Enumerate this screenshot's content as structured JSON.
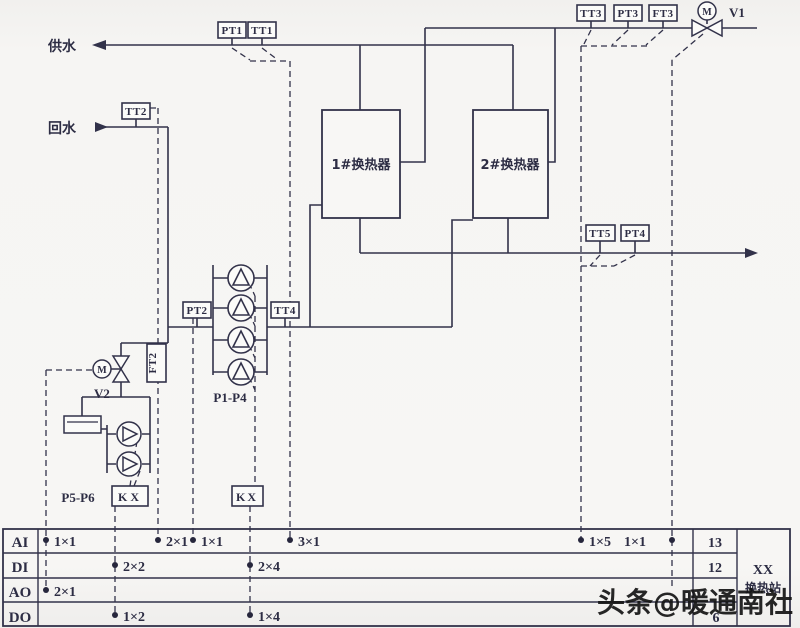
{
  "labels": {
    "gongshui": "供水",
    "huishui": "回水",
    "hx1": "1#换热器",
    "hx2": "2#换热器",
    "p1p4": "P1-P4",
    "p5p6": "P5-P6",
    "v1": "V1",
    "v2": "V2",
    "m1": "M",
    "m2": "M",
    "kx1": "KX",
    "kx2": "KX",
    "pt1": "PT1",
    "tt1": "TT1",
    "tt2": "TT2",
    "ft2": "FT2",
    "pt2": "PT2",
    "tt4": "TT4",
    "tt3": "TT3",
    "pt3": "PT3",
    "ft3": "FT3",
    "tt5": "TT5",
    "pt4": "PT4"
  },
  "table": {
    "row_ai": "AI",
    "row_di": "DI",
    "row_ao": "AO",
    "row_do": "DO",
    "ai_total": "13",
    "di_total": "12",
    "ao_total": "",
    "do_total": "6",
    "station_line1": "XX",
    "station_line2": "换热站",
    "ai_p1": "1×1",
    "ai_p2": "2×1",
    "ai_p3": "1×1",
    "ai_p4": "3×1",
    "ai_p5": "1×5",
    "ai_p6": "1×1",
    "di_p1": "2×2",
    "di_p2": "2×4",
    "ao_p1": "2×1",
    "do_p1": "1×2",
    "do_p2": "1×4"
  },
  "watermark": "头条@暖通南社"
}
